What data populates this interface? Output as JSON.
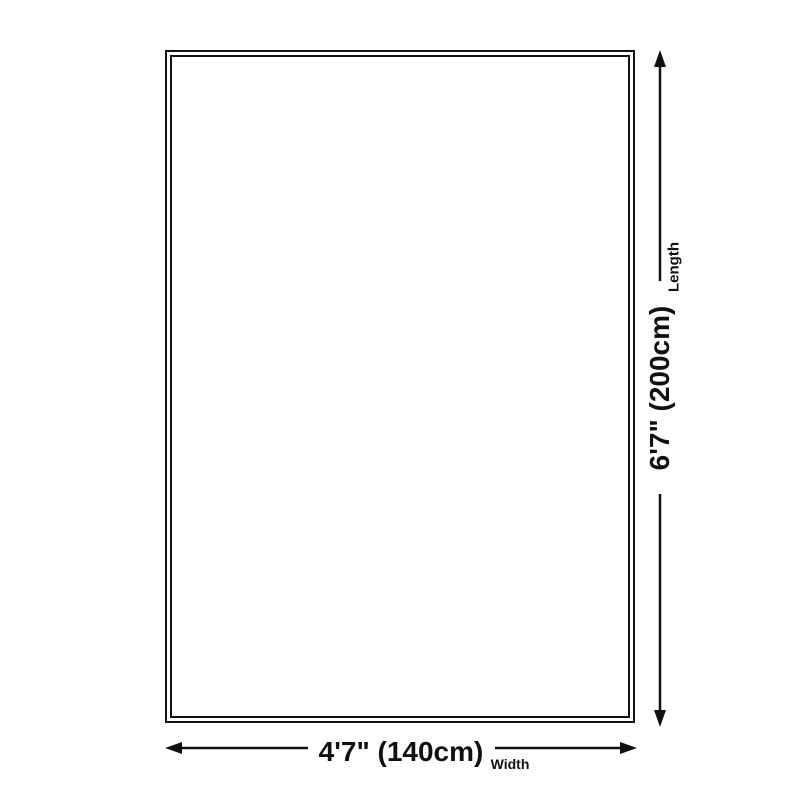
{
  "page": {
    "background_color": "#ffffff",
    "ink_color": "#111111"
  },
  "diagram": {
    "type": "product-size-diagram",
    "shape": "rectangle",
    "dimensions": {
      "length": {
        "value": "6'7\" (200cm)",
        "label": "Length",
        "orientation": "vertical"
      },
      "width": {
        "value": "4'7\" (140cm)",
        "label": "Width",
        "orientation": "horizontal"
      }
    }
  }
}
